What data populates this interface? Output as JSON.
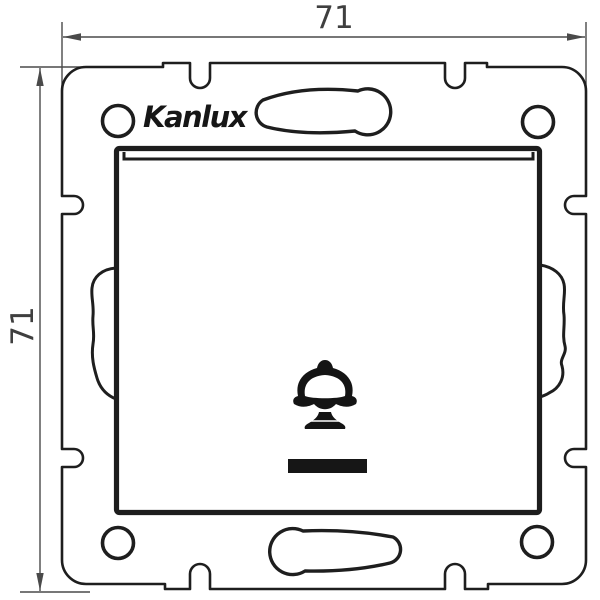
{
  "drawing": {
    "kind": "technical-dimension-drawing",
    "product": {
      "brand_logo": "Kanlux",
      "symbols": {
        "button_symbol": "bell-icon",
        "indicator_window": "indicator-bar"
      }
    },
    "dimensions": {
      "width_mm": "71",
      "height_mm": "71"
    },
    "colors": {
      "background": "#ffffff",
      "outline": "#1e1e1e",
      "dimension_line": "#4a4a4a",
      "dimension_text": "#3f3f3f",
      "solid_fill": "#161616"
    }
  }
}
